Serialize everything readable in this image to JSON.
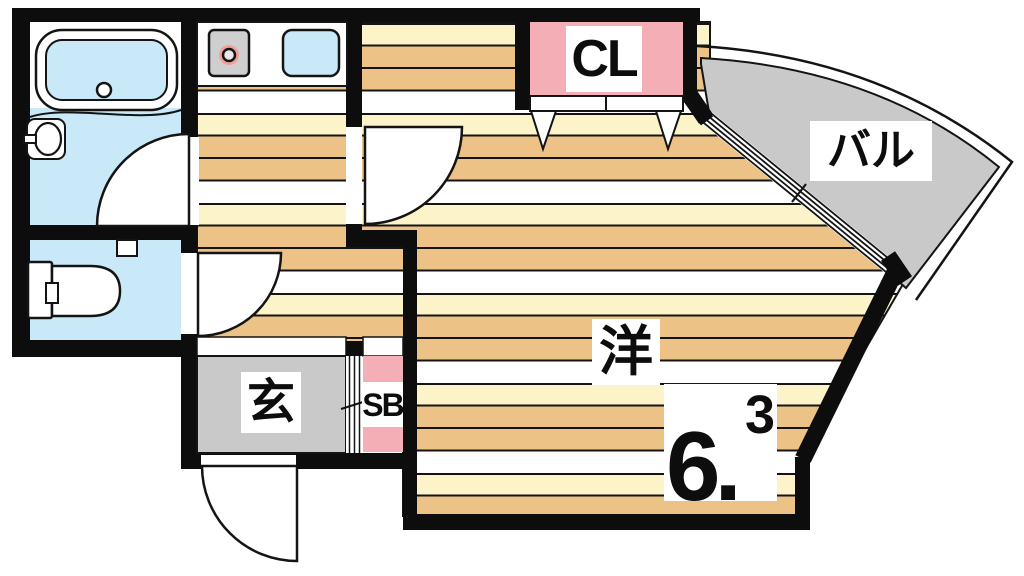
{
  "floorplan": {
    "labels": {
      "closet": "CL",
      "balcony": "バル",
      "entrance": "玄",
      "shoe_box": "SB",
      "room_type": "洋",
      "room_size_main": "6.",
      "room_size_sup": "3"
    },
    "colors": {
      "wall": "#0d0d0d",
      "water_blue": "#c9e9f8",
      "pink": "#f3aeb6",
      "gray": "#c9c9c9",
      "floor_tan": "#edc287",
      "floor_cream": "#fcf4c8",
      "floor_white": "#ffffff",
      "burner_halo": "#f0a09b"
    }
  }
}
